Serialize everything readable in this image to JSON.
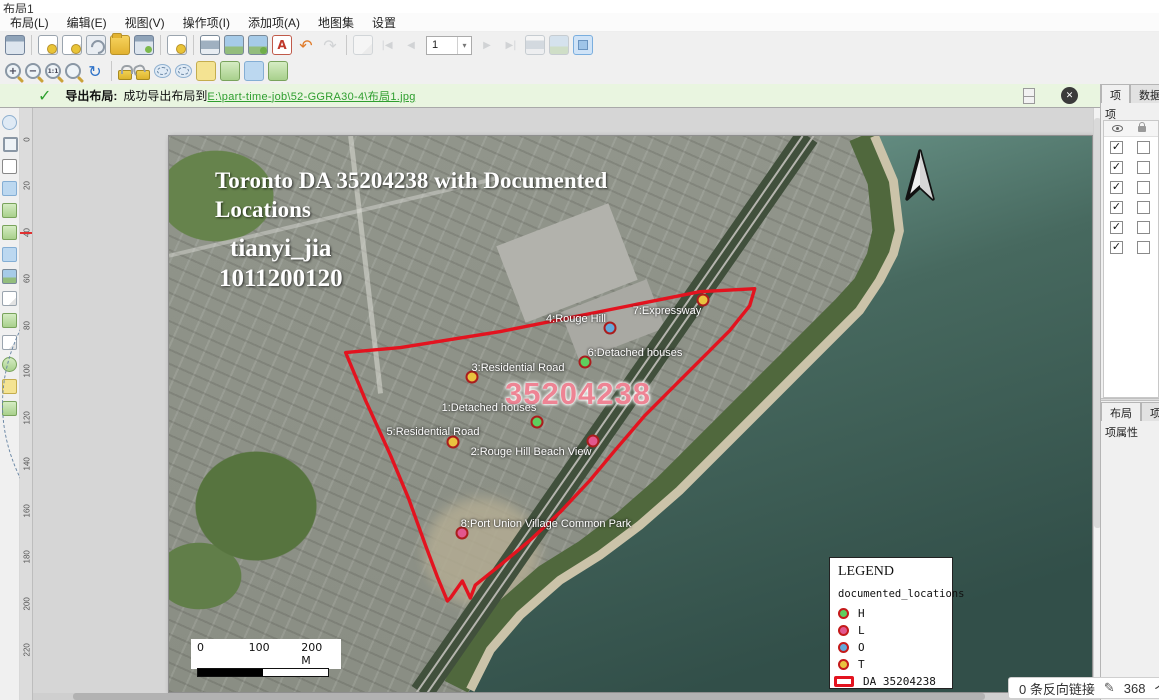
{
  "window_title": "布局1",
  "menu": {
    "items": [
      {
        "label": "布局(L)"
      },
      {
        "label": "编辑(E)"
      },
      {
        "label": "视图(V)"
      },
      {
        "label": "操作项(I)"
      },
      {
        "label": "添加项(A)"
      },
      {
        "label": "地图集"
      },
      {
        "label": "设置"
      }
    ]
  },
  "toolbar": {
    "page_number": "1",
    "icons": {
      "undo": "↶",
      "redo": "↷",
      "refresh": "↻",
      "zoom_in": "+",
      "zoom_out": "−",
      "zoom_actual": "1:1",
      "first": "|◀",
      "prev": "◀",
      "next": "▶",
      "last": "▶|",
      "pdf": "A",
      "dropdown": "▾",
      "close": "✕",
      "check": "✓"
    }
  },
  "message_bar": {
    "title": "导出布局:",
    "text": "成功导出布局到",
    "link": "E:\\part-time-job\\52-GGRA30-4\\布局1.jpg"
  },
  "ruler": {
    "marks": [
      "0",
      "20",
      "40",
      "60",
      "80",
      "100",
      "120",
      "140",
      "160",
      "180",
      "200",
      "220"
    ]
  },
  "right_panel": {
    "tab_items": "项",
    "tab_data": "数据",
    "items_title": "项",
    "check_glyph": "✓",
    "rows": [
      {
        "visible": true
      },
      {
        "visible": true
      },
      {
        "visible": true
      },
      {
        "visible": true
      },
      {
        "visible": true
      },
      {
        "visible": true
      }
    ],
    "tab_layout": "布局",
    "tab_item_props": "项属性",
    "bottom_title": "项属性"
  },
  "status": {
    "backlinks": "0 条反向链接",
    "pencil": "✎",
    "count": "368",
    "suffix": "个"
  },
  "map": {
    "title_line1": "Toronto DA 35204238 with Documented",
    "title_line2": "Locations",
    "author": "tianyi_jia",
    "student_id": "1011200120",
    "da_number_label": "35204238",
    "boundary_color": "#e3131f",
    "markers": [
      {
        "label": "1:Detached houses",
        "category": "H",
        "color": "#5ecf5e",
        "dot_x": 368,
        "dot_y": 286
      },
      {
        "label": "2:Rouge Hill Beach View",
        "category": "L",
        "color": "#e2578e",
        "dot_x": 424,
        "dot_y": 305
      },
      {
        "label": "3:Residential Road",
        "category": "T",
        "color": "#eac33f",
        "dot_x": 303,
        "dot_y": 241
      },
      {
        "label": "4:Rouge Hill",
        "category": "O",
        "color": "#63a9da",
        "dot_x": 441,
        "dot_y": 192
      },
      {
        "label": "5:Residential Road",
        "category": "T",
        "color": "#eac33f",
        "dot_x": 284,
        "dot_y": 306
      },
      {
        "label": "6:Detached houses",
        "category": "H",
        "color": "#5ecf5e",
        "dot_x": 416,
        "dot_y": 226
      },
      {
        "label": "7:Expressway",
        "category": "T",
        "color": "#eac33f",
        "dot_x": 534,
        "dot_y": 164
      },
      {
        "label": "8:Port Union Village Common Park",
        "category": "L",
        "color": "#e2578e",
        "dot_x": 293,
        "dot_y": 397
      }
    ],
    "legend": {
      "title": "LEGEND",
      "layer_name": "documented_locations",
      "items": [
        {
          "label": "H",
          "color": "#5ecf5e"
        },
        {
          "label": "L",
          "color": "#e2578e"
        },
        {
          "label": "O",
          "color": "#63a9da"
        },
        {
          "label": "T",
          "color": "#eac33f"
        },
        {
          "label": "DA 35204238",
          "color": "#e3131f",
          "type": "rect"
        }
      ]
    },
    "scalebar": {
      "ticks": [
        "0",
        "100",
        "200 M"
      ]
    }
  }
}
